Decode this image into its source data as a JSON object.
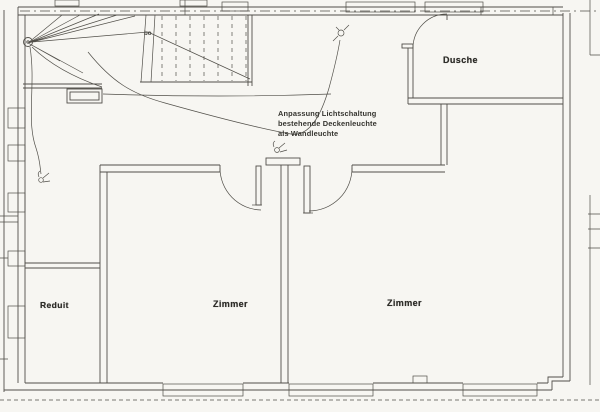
{
  "plan": {
    "rooms": [
      {
        "id": "dusche",
        "label": "Dusche"
      },
      {
        "id": "zimmer-left",
        "label": "Zimmer"
      },
      {
        "id": "zimmer-right",
        "label": "Zimmer"
      },
      {
        "id": "reduit",
        "label": "Reduit"
      }
    ],
    "annotation": {
      "lines": [
        "Anpassung Lichtschaltung",
        "bestehende Deckenleuchte",
        "als Wandleuchte"
      ]
    },
    "stair_label": "bo"
  },
  "colors": {
    "paper": "#f7f6f2",
    "ink": "#514f49",
    "label_text": "#2e2d29"
  }
}
